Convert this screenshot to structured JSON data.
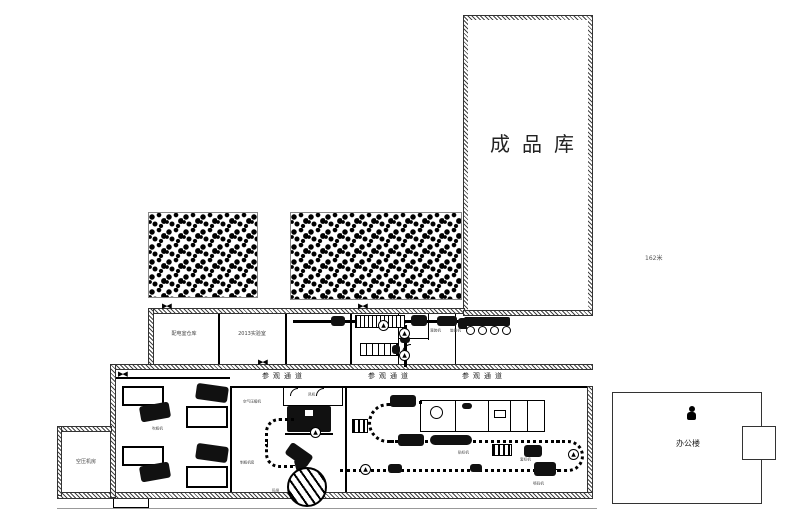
{
  "plan": {
    "warehouse_label": "成品库",
    "dim_note": "162米",
    "corridor_label": "参观通道",
    "office_label": "办公楼",
    "rooms": {
      "power_room": "配电室仓库",
      "lab_room": "2013实验室",
      "compressor_wing": "空压机房",
      "air_compressor": "空气压缩机",
      "blow_molding": "制瓶机房",
      "fan_room": "风机"
    },
    "equipment": {
      "blow_machine": "吹瓶机",
      "filling_machine": "灌装机",
      "capping_machine": "旋盖机",
      "labeling_machine": "贴标机",
      "sleeve_machine": "套标机",
      "coder": "喷码机",
      "palletizer": "码垛"
    }
  },
  "icons": {
    "dir_arrow": "▲",
    "double_door": "▶◀"
  }
}
